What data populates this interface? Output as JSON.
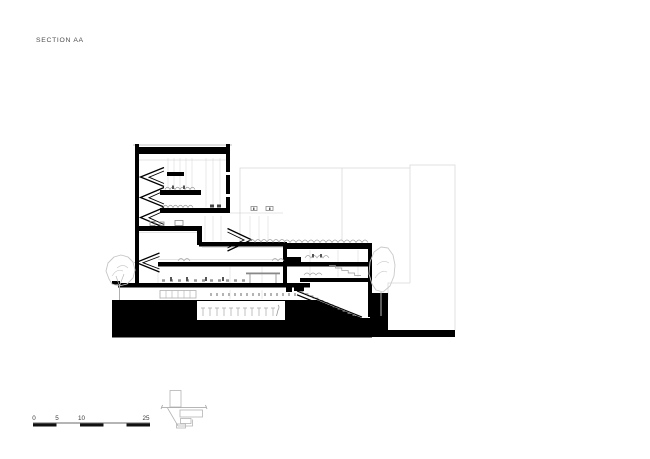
{
  "title": {
    "label": "SECTION AA"
  },
  "scale_bar": {
    "labels": [
      "0",
      "5",
      "10",
      "25"
    ]
  },
  "colors": {
    "paper": "#ffffff",
    "ink": "#000000",
    "annotation_text": "#4d4d4d",
    "medium_linework": "#909090",
    "light_linework": "#c8c8c8"
  },
  "drawing": {
    "kind": "building cross section",
    "features": [
      "tower-block",
      "low-wing",
      "green-roof",
      "ground-poche",
      "basement-room",
      "stairs",
      "trees",
      "background-outline",
      "key-plan",
      "scale-bar"
    ]
  }
}
